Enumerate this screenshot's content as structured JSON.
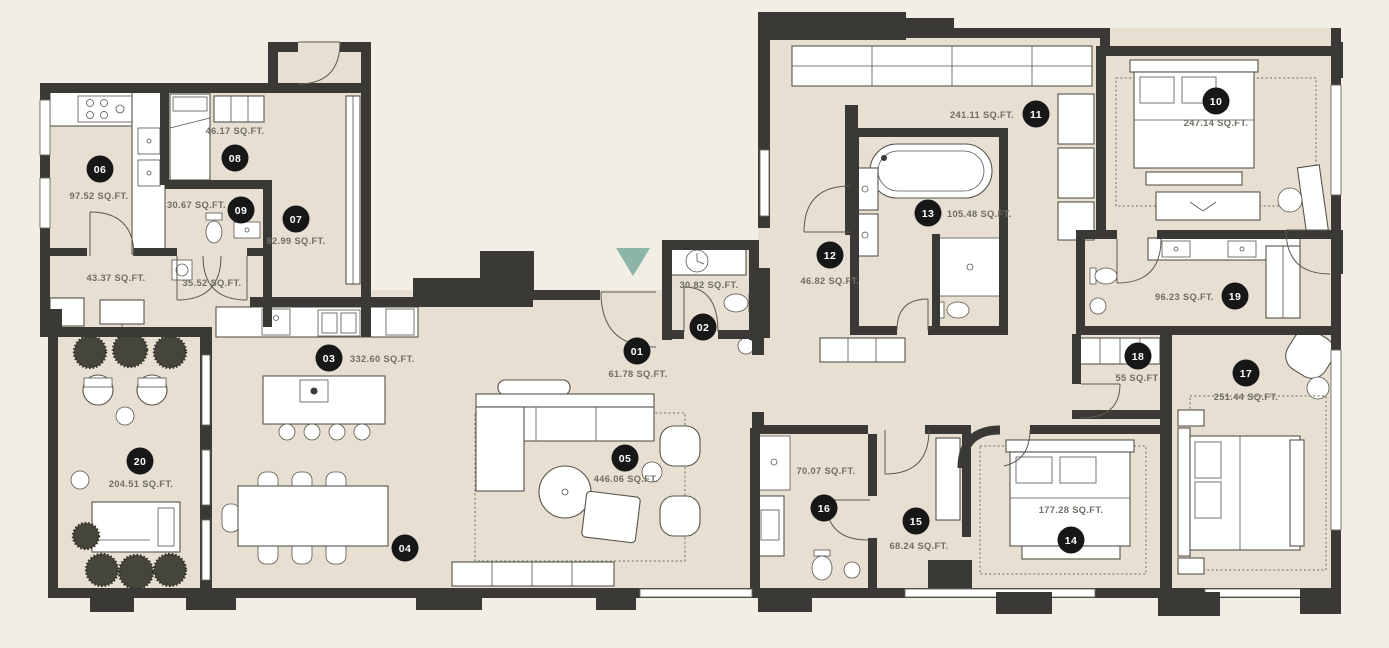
{
  "page": {
    "background": "#f1eee5",
    "floor_color": "#e7e0d2",
    "wall_color": "#3a3935",
    "marker_bg": "#171717",
    "marker_text_color": "#ffffff",
    "label_color": "#6f6d64",
    "accent_teal": "#8cb5a8"
  },
  "entry_arrow": {
    "x": 633,
    "y": 248,
    "width": 34,
    "height": 28
  },
  "rooms": [
    {
      "number": "01",
      "area": "61.78 SQ.FT.",
      "marker": {
        "x": 637,
        "y": 351
      },
      "label": {
        "x": 638,
        "y": 377,
        "anchor": "middle"
      }
    },
    {
      "number": "02",
      "area": "30.82 SQ.FT.",
      "marker": {
        "x": 703,
        "y": 327
      },
      "label": {
        "x": 709,
        "y": 288,
        "anchor": "middle"
      }
    },
    {
      "number": "03",
      "area": "332.60 SQ.FT.",
      "marker": {
        "x": 329,
        "y": 358
      },
      "label": {
        "x": 350,
        "y": 362,
        "anchor": "start"
      }
    },
    {
      "number": "04",
      "area": "",
      "marker": {
        "x": 405,
        "y": 548
      },
      "label": null
    },
    {
      "number": "05",
      "area": "446.06 SQ.FT.",
      "marker": {
        "x": 625,
        "y": 458
      },
      "label": {
        "x": 626,
        "y": 482,
        "anchor": "middle"
      }
    },
    {
      "number": "06",
      "area": "97.52 SQ.FT.",
      "marker": {
        "x": 100,
        "y": 169
      },
      "label": {
        "x": 99,
        "y": 199,
        "anchor": "middle"
      }
    },
    {
      "number": "07",
      "area": "82.99 SQ.FT.",
      "marker": {
        "x": 296,
        "y": 219
      },
      "label": {
        "x": 296,
        "y": 244,
        "anchor": "middle"
      }
    },
    {
      "number": "08",
      "area": "46.17 SQ.FT.",
      "marker": {
        "x": 235,
        "y": 158
      },
      "label": {
        "x": 235,
        "y": 134,
        "anchor": "middle"
      }
    },
    {
      "number": "09",
      "area": "30.67 SQ.FT.",
      "marker": {
        "x": 241,
        "y": 210
      },
      "label": {
        "x": 226,
        "y": 208,
        "anchor": "end"
      }
    },
    {
      "number": "10",
      "area": "247.14 SQ.FT.",
      "marker": {
        "x": 1216,
        "y": 101
      },
      "label": {
        "x": 1216,
        "y": 126,
        "anchor": "middle"
      }
    },
    {
      "number": "11",
      "area": "241.11 SQ.FT.",
      "marker": {
        "x": 1036,
        "y": 114
      },
      "label": {
        "x": 1014,
        "y": 118,
        "anchor": "end"
      }
    },
    {
      "number": "12",
      "area": "46.82 SQ.FT.",
      "marker": {
        "x": 830,
        "y": 255
      },
      "label": {
        "x": 830,
        "y": 284,
        "anchor": "middle"
      }
    },
    {
      "number": "13",
      "area": "105.48 SQ.FT.",
      "marker": {
        "x": 928,
        "y": 213
      },
      "label": {
        "x": 947,
        "y": 217,
        "anchor": "start"
      }
    },
    {
      "number": "14",
      "area": "177.28 SQ.FT.",
      "marker": {
        "x": 1071,
        "y": 540
      },
      "label": {
        "x": 1071,
        "y": 513,
        "anchor": "middle"
      }
    },
    {
      "number": "15",
      "area": "68.24 SQ.FT.",
      "marker": {
        "x": 916,
        "y": 521
      },
      "label": {
        "x": 919,
        "y": 549,
        "anchor": "middle"
      }
    },
    {
      "number": "16",
      "area": "70.07 SQ.FT.",
      "marker": {
        "x": 824,
        "y": 508
      },
      "label": {
        "x": 826,
        "y": 474,
        "anchor": "middle"
      }
    },
    {
      "number": "17",
      "area": "251.44 SQ.FT.",
      "marker": {
        "x": 1246,
        "y": 373
      },
      "label": {
        "x": 1246,
        "y": 400,
        "anchor": "middle"
      }
    },
    {
      "number": "18",
      "area": "55 SQ.FT",
      "marker": {
        "x": 1138,
        "y": 356
      },
      "label": {
        "x": 1137,
        "y": 381,
        "anchor": "middle"
      }
    },
    {
      "number": "19",
      "area": "96.23 SQ.FT.",
      "marker": {
        "x": 1235,
        "y": 296
      },
      "label": {
        "x": 1214,
        "y": 300,
        "anchor": "end"
      }
    },
    {
      "number": "20",
      "area": "204.51 SQ.FT.",
      "marker": {
        "x": 140,
        "y": 461
      },
      "label": {
        "x": 141,
        "y": 487,
        "anchor": "middle"
      }
    }
  ],
  "hall_labels": [
    {
      "text": "43.37 SQ.FT.",
      "x": 116,
      "y": 281
    },
    {
      "text": "35.52 SQ.FT.",
      "x": 212,
      "y": 286
    }
  ]
}
